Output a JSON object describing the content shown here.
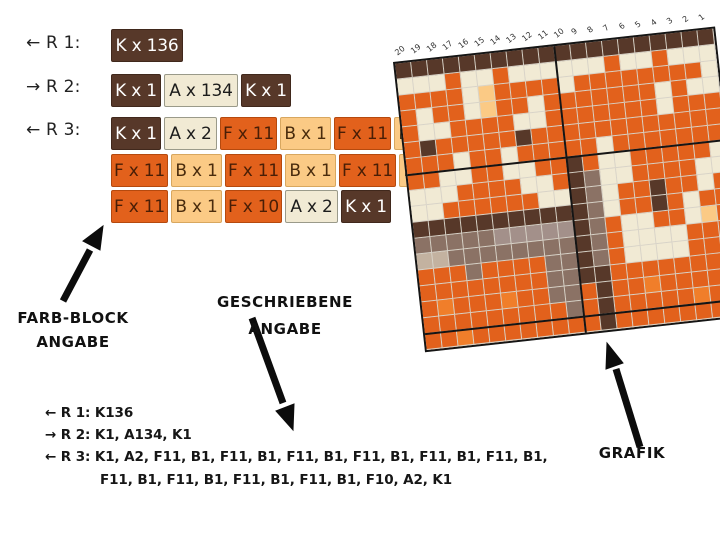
{
  "palette": {
    "K": "#573829",
    "A": "#f1ead4",
    "F": "#e2611c",
    "B": "#fbca85",
    "G": "#8b7265",
    "M": "#a3908a",
    "L": "#c3b2a0",
    "O": "#f07e2a"
  },
  "block_section": {
    "row_labels": [
      "← R 1:",
      "→ R 2:",
      "← R 3:"
    ],
    "rows": [
      {
        "blocks": [
          {
            "text": "K x 136",
            "c": "K"
          }
        ]
      },
      {
        "blocks": [
          {
            "text": "K x 1",
            "c": "K"
          },
          {
            "text": "A x 134",
            "c": "A"
          },
          {
            "text": "K x 1",
            "c": "K"
          }
        ]
      },
      {
        "blocks": [
          {
            "text": "K x 1",
            "c": "K"
          },
          {
            "text": "A x 2",
            "c": "A"
          },
          {
            "text": "F x 11",
            "c": "F"
          },
          {
            "text": "B x 1",
            "c": "B"
          },
          {
            "text": "F x 11",
            "c": "F"
          },
          {
            "text": "B x 1",
            "c": "B"
          }
        ]
      },
      {
        "blocks": [
          {
            "text": "F x 11",
            "c": "F"
          },
          {
            "text": "B x 1",
            "c": "B"
          },
          {
            "text": "F x 11",
            "c": "F"
          },
          {
            "text": "B x 1",
            "c": "B"
          },
          {
            "text": "F x 11",
            "c": "F"
          },
          {
            "text": "B x 1",
            "c": "B"
          }
        ]
      },
      {
        "blocks": [
          {
            "text": "F x 11",
            "c": "F"
          },
          {
            "text": "B x 1",
            "c": "B"
          },
          {
            "text": "F x 10",
            "c": "F"
          },
          {
            "text": "A x 2",
            "c": "A"
          },
          {
            "text": "K x 1",
            "c": "K"
          }
        ]
      }
    ]
  },
  "annotations": {
    "farb_block": [
      "FARB-BLOCK",
      "ANGABE"
    ],
    "geschriebene": [
      "GESCHRIEBENE",
      "ANGABE"
    ],
    "grafik": "GRAFIK"
  },
  "written_section": {
    "lines": [
      "← R 1: K136",
      "→ R 2: K1, A134, K1",
      "← R 3: K1, A2, F11, B1, F11, B1, F11, B1, F11, B1, F11, B1, F11, B1,",
      "F11, B1, F11, B1, F11, B1, F11, B1, F10, A2, K1"
    ]
  },
  "chart_data": {
    "type": "heatmap",
    "title": "knitting colorwork chart (fox motif)",
    "column_numbers": [
      20,
      19,
      18,
      17,
      16,
      15,
      14,
      13,
      12,
      11,
      10,
      9,
      8,
      7,
      6,
      5,
      4,
      3,
      2,
      1
    ],
    "legend": {
      "K": "dark brown",
      "A": "cream",
      "F": "orange",
      "B": "peach",
      "G": "taupe",
      "M": "grey taupe",
      "L": "light beige",
      "O": "bright orange"
    },
    "pattern_rows": [
      "KKKKKKKKKKKKKKKKKKKK",
      "AAAFAAFAAAAAAFAAFAAA",
      "FFFFABFFFFAFFFFFFFFA",
      "FAFFABFFAFFFFFFFAFA A",
      "FAAFFFFAAFFFFFFFAFFF",
      "FKFFFFFKFFFFFFFFFFFF",
      "FFFAFFAFFFFFAFFFFFFF",
      "FFAAFFAAFFKFAAFFFFFA",
      "AAAFFFFAAFKGAAFFFFAA",
      "AAFFFFFFAAKGAFFKFFAF",
      "KKKKKKKKKKKGAFFKFAFF",
      "GGGGGMMMMMKGFAAFFABF",
      "LLGGGGGGGGKGFAAAAFFF",
      "FFFGFFFFGGKGFAAAAFFF",
      "FFFFFFFFGGKKFFFFFFFF",
      "FOFFFOFFGGFKFFOFFFFF",
      "FFFFFFFFFGFKFFFFFOFF",
      "FFOFFFFFFFFKFFFFFFFF"
    ]
  }
}
